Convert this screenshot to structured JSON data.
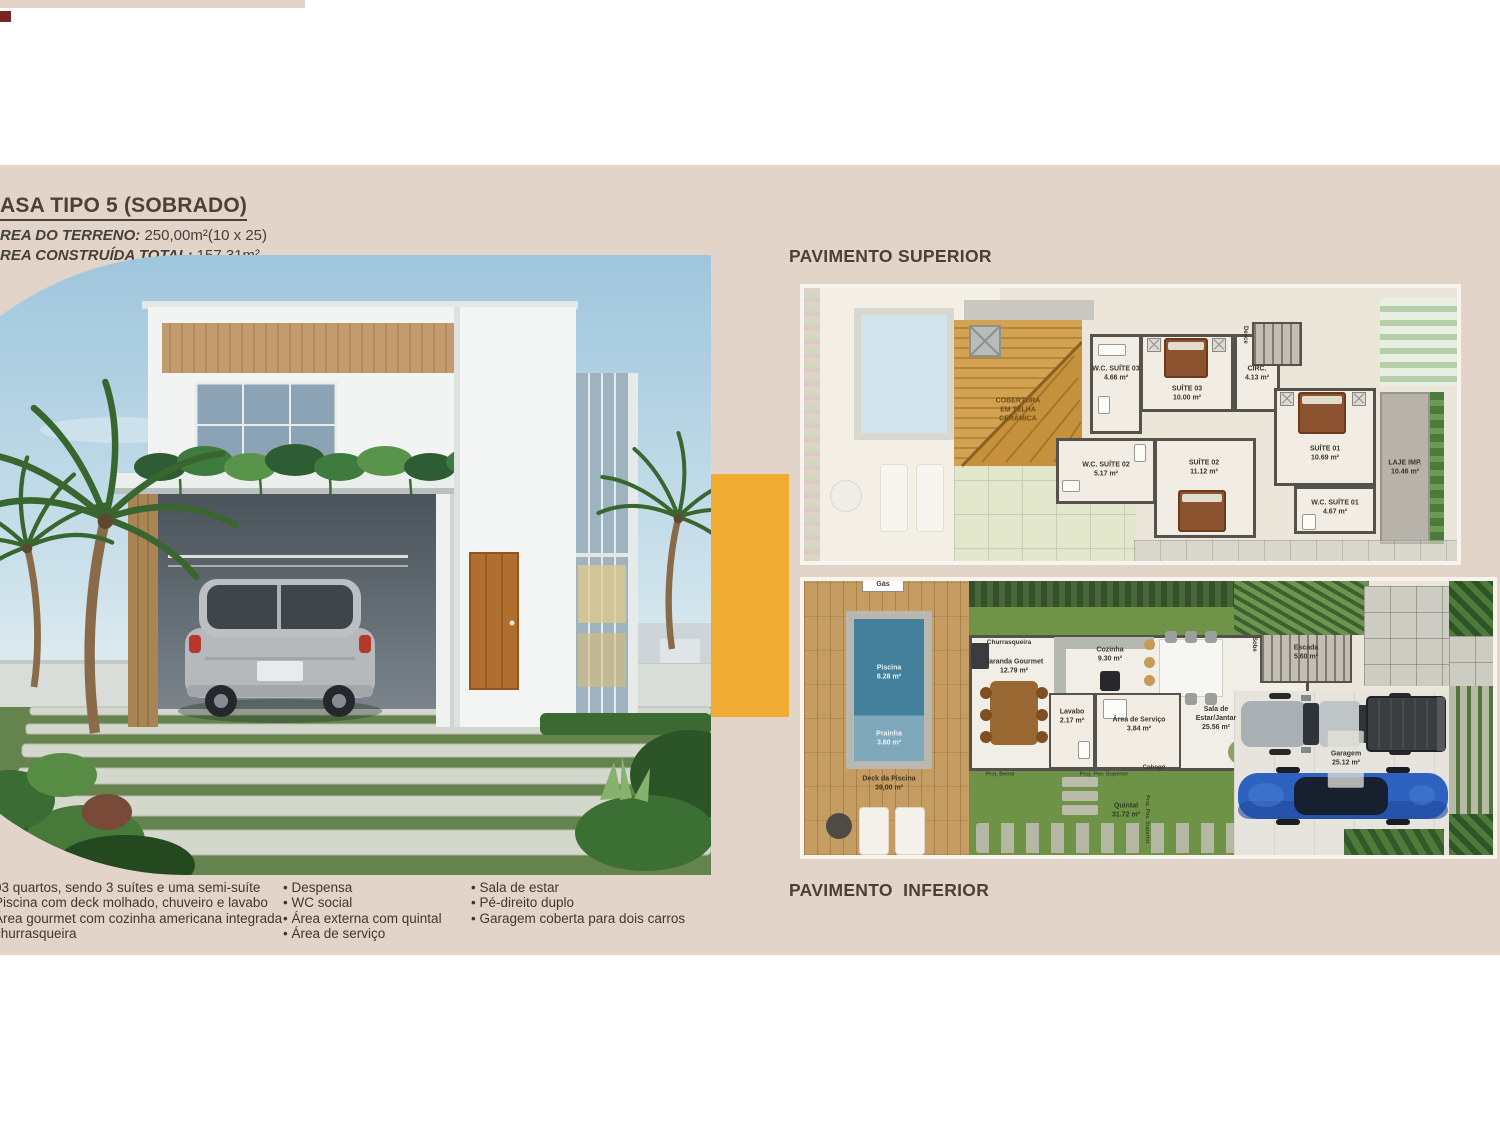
{
  "colors": {
    "page_band": "#e3d4ca",
    "accent_orange": "#f0ab33",
    "heading_brown": "#4c4132",
    "maroon_square": "#7a2620"
  },
  "header": {
    "title": "ASA TIPO 5 (SOBRADO)",
    "terrain_label": "REA DO TERRENO:",
    "terrain_value": "250,00m²(10 x 25)",
    "built_label": "REA CONSTRUÍDA TOTAL:",
    "built_value": "157,31m²"
  },
  "sections": {
    "superior_title": "PAVIMENTO SUPERIOR",
    "inferior_title": "PAVIMENTO  INFERIOR"
  },
  "features": {
    "col1": [
      "03 quartos, sendo 3 suítes e uma semi-suíte",
      "Piscina com deck molhado, chuveiro e lavabo",
      "Área gourmet com cozinha americana integrada",
      "churrasqueira"
    ],
    "col2": [
      "Despensa",
      "WC social",
      "Área externa com quintal",
      "Área de serviço"
    ],
    "col3": [
      "Sala de estar",
      "Pé-direito duplo",
      "Garagem coberta para dois carros"
    ]
  },
  "plan_superior": {
    "roof_label": "COBERTURA\nEM TELHA\nCERÂMICA",
    "stair_label": "Desce",
    "rooms": {
      "wc3": {
        "name": "W.C. SUÍTE 03",
        "area": "4.66 m²"
      },
      "s3": {
        "name": "SUÍTE 03",
        "area": "10.00 m²"
      },
      "circ": {
        "name": "CIRC.",
        "area": "4.13 m²"
      },
      "wc2": {
        "name": "W.C. SUÍTE 02",
        "area": "5.17 m²"
      },
      "s2": {
        "name": "SUÍTE 02",
        "area": "11.12 m²"
      },
      "s1": {
        "name": "SUÍTE 01",
        "area": "10.69 m²"
      },
      "wc1": {
        "name": "W.C. SUÍTE 01",
        "area": "4.67 m²"
      },
      "laje": {
        "name": "LAJE IMP.",
        "area": "10.46 m²"
      }
    }
  },
  "plan_inferior": {
    "gas_label": "Gás",
    "stair_label": "Sobe",
    "cobogo_label": "Cobogó",
    "churrasqueira_label": "Churrasqueira",
    "proj_superior_label": "Proj. Pav. Superior",
    "proj_beiral_label": "Proj. Beiral",
    "rooms": {
      "piscina": {
        "name": "Piscina",
        "area": "8.28 m²"
      },
      "prainha": {
        "name": "Prainha",
        "area": "3.60 m²"
      },
      "deck": {
        "name": "Deck da Piscina",
        "area": "39,00 m²"
      },
      "varanda": {
        "name": "Varanda Gourmet",
        "area": "12.79 m²"
      },
      "cozinha": {
        "name": "Cozinha",
        "area": "9.30 m²"
      },
      "lavabo": {
        "name": "Lavabo",
        "area": "2.17 m²"
      },
      "servico": {
        "name": "Área de Serviço",
        "area": "3.84 m²"
      },
      "sala": {
        "name": "Sala de\nEstar/Jantar",
        "area": "25.56 m²"
      },
      "escada": {
        "name": "Escada",
        "area": "5.60 m²"
      },
      "quintal": {
        "name": "Quintal",
        "area": "31.72 m²"
      },
      "garagem": {
        "name": "Garagem",
        "area": "25.12 m²"
      }
    }
  }
}
